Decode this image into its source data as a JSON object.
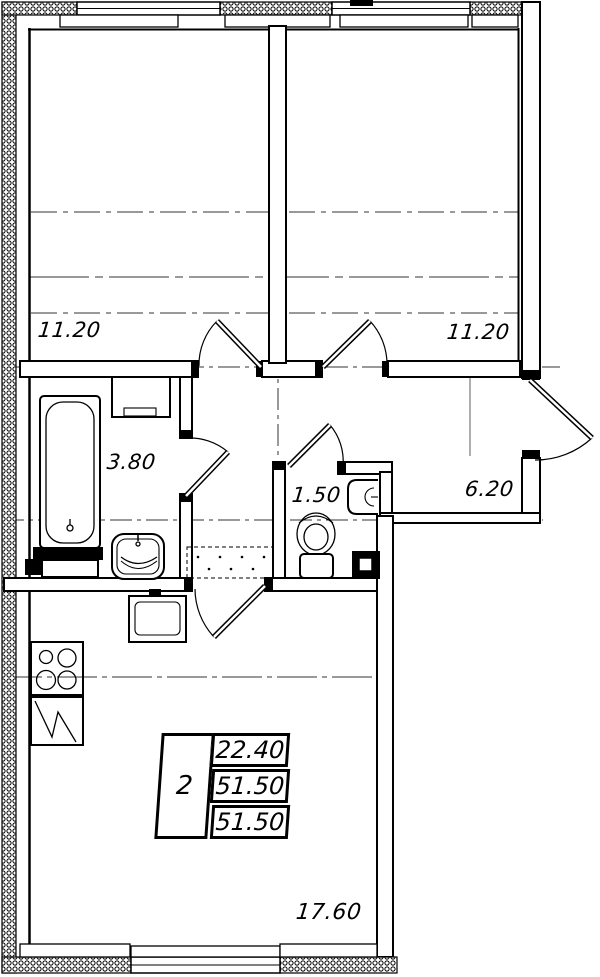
{
  "plan": {
    "type": "apartment-floor-plan",
    "rooms": [
      {
        "name": "room-left",
        "area": "11.20"
      },
      {
        "name": "room-right",
        "area": "11.20"
      },
      {
        "name": "bathroom",
        "area": "3.80"
      },
      {
        "name": "wc",
        "area": "1.50"
      },
      {
        "name": "hallway",
        "area": "6.20"
      },
      {
        "name": "kitchen-living",
        "area": "17.60"
      }
    ],
    "info_table": {
      "rooms_count": "2",
      "rows": [
        "22.40",
        "51.50",
        "51.50"
      ]
    },
    "colors": {
      "line": "#000000",
      "background": "#ffffff"
    }
  }
}
